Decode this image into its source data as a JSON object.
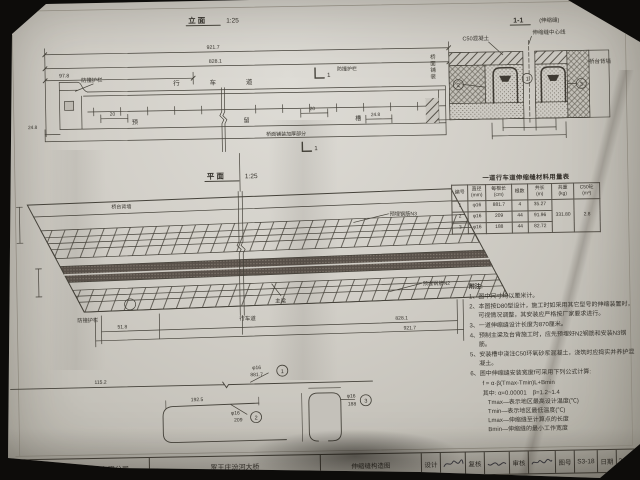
{
  "elevation": {
    "title": "立 面",
    "scale": "1:25",
    "dim_total": "921.7",
    "dim_inner": "828.1",
    "dim_left": "97.8",
    "dim_end_left": "24.8",
    "dim_end_right": "24.8",
    "dim_20_left": "20",
    "dim_20_right": "20",
    "label_barrier_left": "防撞护栏",
    "label_barrier_right": "防撞护栏",
    "label_lane": "行 车 道",
    "label_slot": "预 留 槽",
    "label_thicken": "桥面铺装加厚部分",
    "section_no": "1"
  },
  "section": {
    "title": "1-1",
    "subtitle": "(伸缩缝)",
    "label_c50": "C50混凝土",
    "label_center": "伸缩缝中心线",
    "label_backwall": "桥台背墙",
    "label_pavement": "桥面铺装",
    "c1": "1",
    "c2": "2",
    "c3": "3"
  },
  "plan": {
    "title": "平 面",
    "scale": "1:25",
    "label_backwall": "桥台背墙",
    "label_n3": "预埋钢筋N3",
    "label_n2": "预埋钢筋N2",
    "label_girder": "主梁",
    "label_lane": "行车道",
    "label_barrier": "防撞护栏",
    "dim_left": "51.8",
    "dim_inner": "828.1",
    "dim_total": "921.7",
    "dim_offset": "115.2"
  },
  "bars": {
    "n1": {
      "dia": "φ16",
      "len": "881.7",
      "no": "1"
    },
    "n2": {
      "dia": "φ16",
      "len": "209",
      "top": "192.5",
      "no": "2"
    },
    "n3": {
      "dia": "φ16",
      "len": "188",
      "no": "3"
    }
  },
  "table": {
    "title": "一道行车道伸缩缝材料用量表",
    "headers": [
      "编号",
      "直径\n(mm)",
      "每根长\n(cm)",
      "根数",
      "共长\n(m)",
      "共重\n(kg)",
      "C50砼\n(m³)"
    ],
    "rows": [
      [
        "1",
        "φ16",
        "881.7",
        "4",
        "35.27"
      ],
      [
        "2",
        "φ16",
        "209",
        "44",
        "91.96"
      ],
      [
        "3",
        "φ16",
        "188",
        "44",
        "82.72"
      ]
    ],
    "total_weight": "331.80",
    "concrete": "2.8"
  },
  "notes": {
    "heading": "附注:",
    "items": [
      "1、图中尺寸均以厘米计。",
      "2、本图按D80型设计，施工时如采用其它型号的伸缩装置时，可视情况调整，其安装应严格按厂家要求进行。",
      "3、一道伸缩缝设计长度为870厘米。",
      "4、预制主梁及台背施工时，应先预埋好N2钢筋和安装N3钢筋。",
      "5、安装槽中浇注C50环氧砂浆混凝土，浇筑时应捣实并养护混凝土。",
      "6、图中伸缩缝安装宽度f可采用下列公式计算:"
    ],
    "formula": "f = α·β(Tmax-Tmin)L+Bmin",
    "where": "其中: α=0.00001　β=1.2~1.4",
    "defs": [
      "Tmax—表示地区最高设计温度(℃)",
      "Tmin—表示地区最低温度(℃)",
      "Lmax—伸缩缝至计算点的长度",
      "Bmin—伸缩缝的最小工作宽度"
    ]
  },
  "titleblock": {
    "company": "山西诚达公路勘察设计有限公司",
    "project": "罗王庄汾河大桥",
    "sheet": "伸缩缝构造图",
    "design_label": "设计",
    "check_label": "复核",
    "review_label": "审核",
    "no_label": "图号",
    "no_value": "S3-18",
    "date_label": "日期",
    "date_value": "2008.12"
  }
}
